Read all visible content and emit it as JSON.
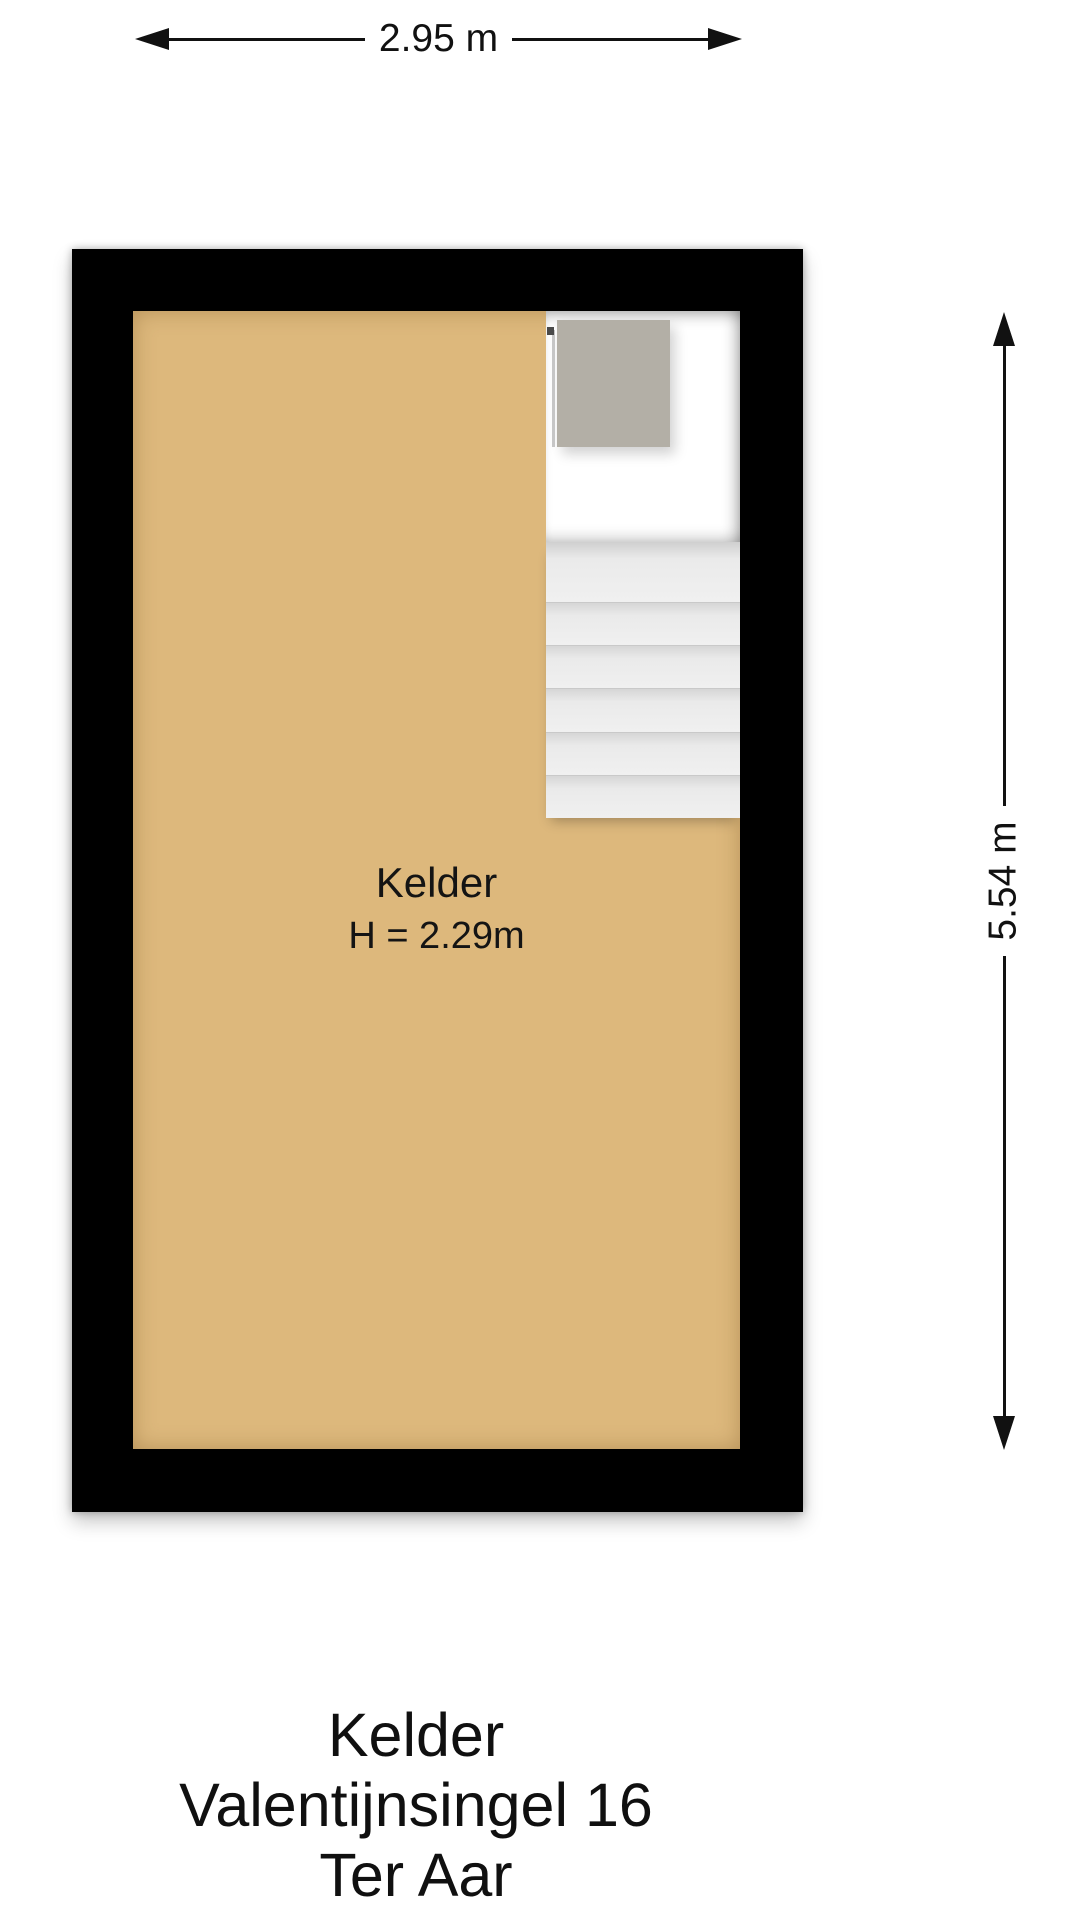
{
  "plan": {
    "type": "floor-plan",
    "floor_name": "Kelder"
  },
  "dimensions": {
    "width_label": "2.95 m",
    "height_label": "5.54 m"
  },
  "room": {
    "name": "Kelder",
    "ceiling_height_label": "H = 2.29m"
  },
  "staircase": {
    "step_count": 6
  },
  "title": {
    "lines": [
      "Kelder",
      "Valentijnsingel 16",
      "Ter Aar"
    ]
  },
  "colors": {
    "wall": "#000000",
    "floor": "#ddb87c",
    "stairwell": "#ffffff",
    "landing": "#b3afa6",
    "step": "#ededed",
    "ink": "#111111"
  }
}
